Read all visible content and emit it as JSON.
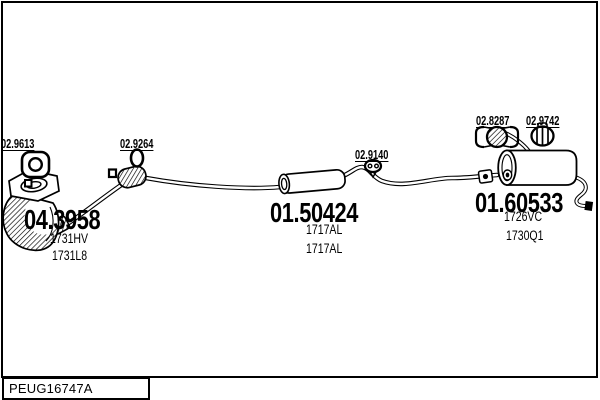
{
  "footer": {
    "code": "PEUG16747A"
  },
  "parts": {
    "front_gasket": {
      "label": "02.9613",
      "icon": "flange-gasket-icon"
    },
    "mid_seal": {
      "label": "02.9264",
      "icon": "ring-seal-icon"
    },
    "mid_hanger": {
      "label": "02.9140",
      "icon": "rubber-hanger-icon"
    },
    "rear_clamp": {
      "label": "02.8287",
      "icon": "clamp-icon"
    },
    "rear_mount": {
      "label": "02.9742",
      "icon": "rubber-mount-icon"
    },
    "catalyst": {
      "number": "04.3958",
      "ref1": "1731HV",
      "ref2": "1731L8"
    },
    "centre_silencer": {
      "number": "01.50424",
      "ref1": "1717AL",
      "ref2": "1717AL"
    },
    "rear_silencer": {
      "number": "01.60533",
      "ref1": "1726VC",
      "ref2": "1730Q1"
    }
  },
  "colors": {
    "line": "#000000",
    "background": "#ffffff"
  }
}
